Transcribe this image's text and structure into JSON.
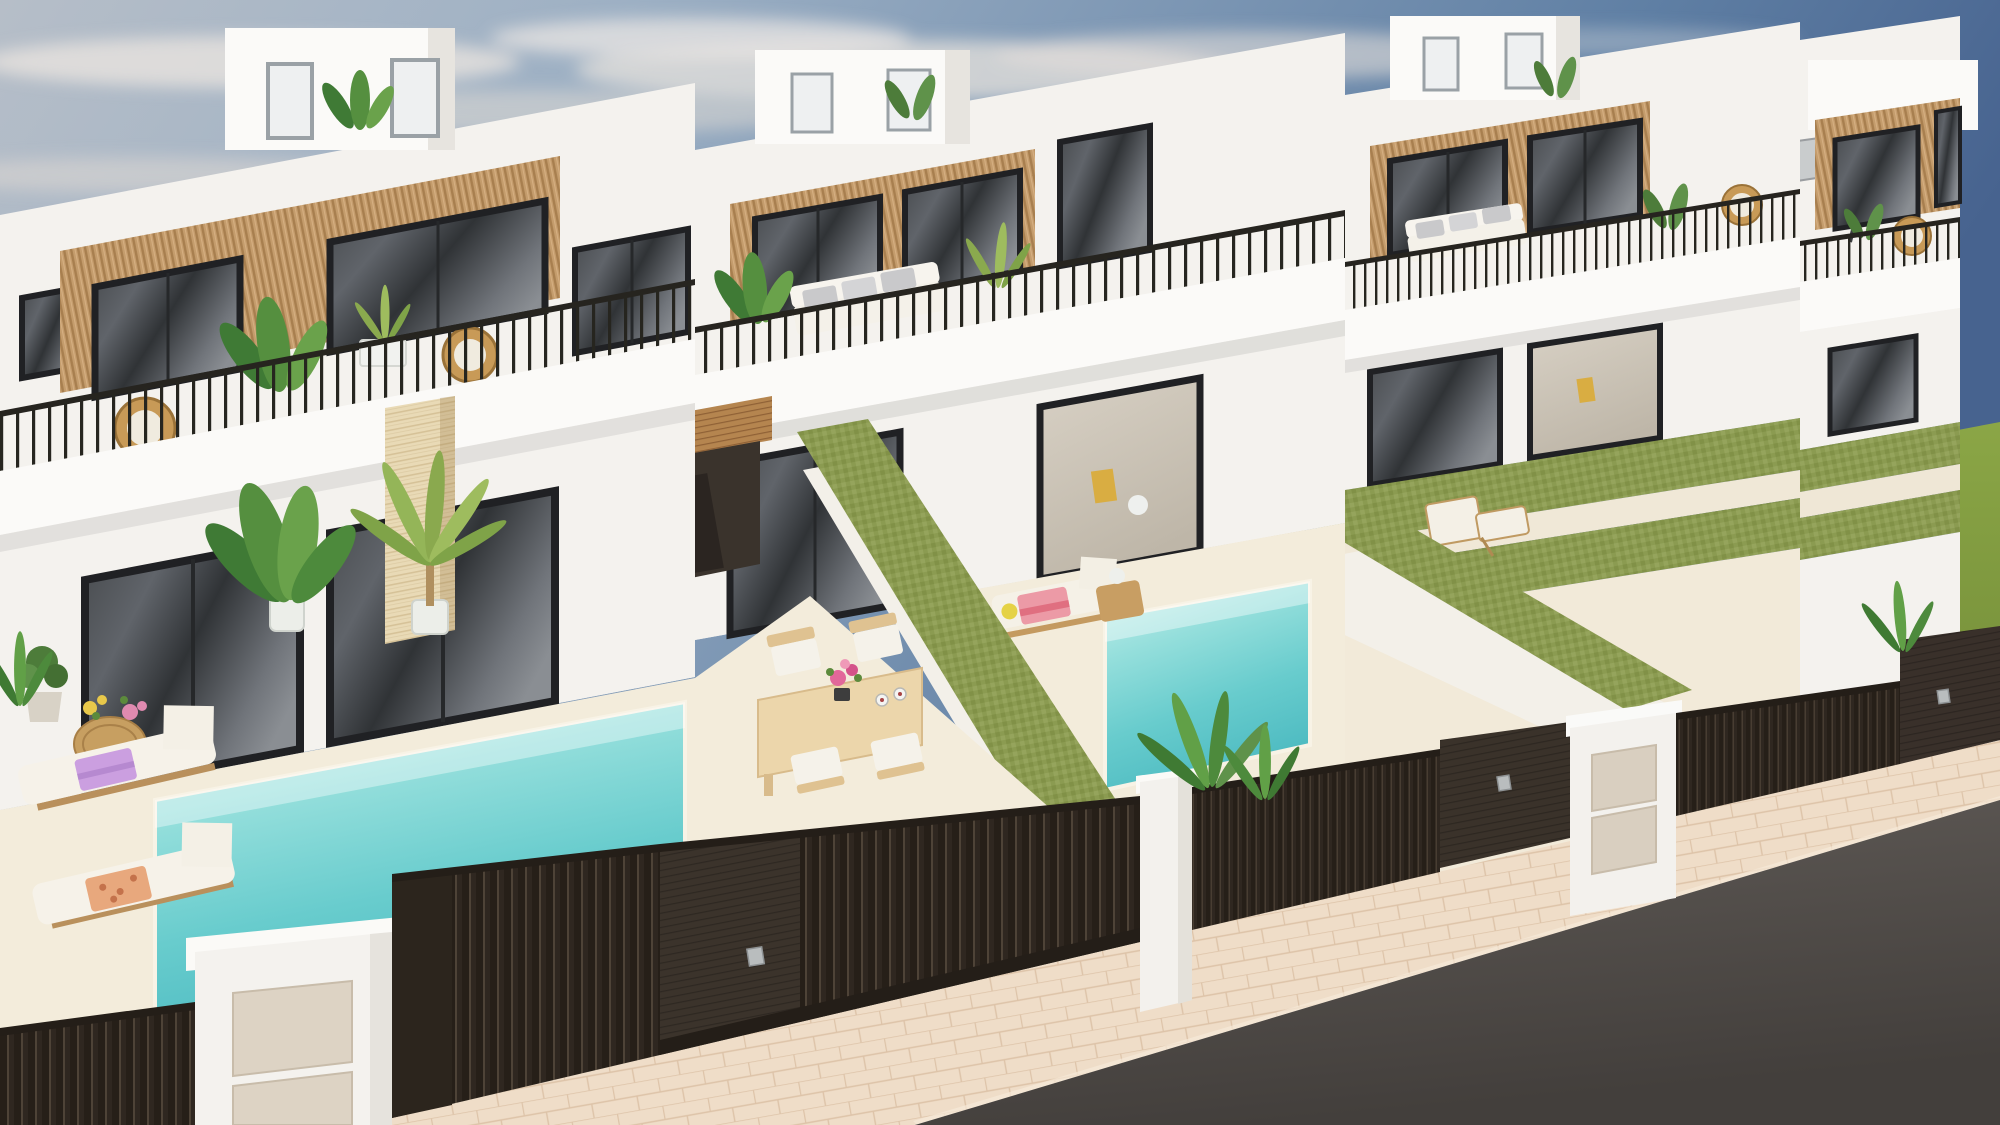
{
  "scene": {
    "description": "Daytime 3D architectural rendering, elevated street view of a row of modern white two-storey villas with rooftop terrace boxes, wood-slat facade accents, black-framed glass doors, balconies with thin black railings and rattan chairs, travertine pillar accents, private cream patios each with a small turquoise plunge pool, sun loungers with colourful towels, an outdoor dining set with pink flowers, green privacy hedge walls and artificial-grass terraces between units, dark brown slatted entrance gates and fences with white mailbox pillars along a beige paved sidewalk, and a dark asphalt road in the bottom-right corner under a partly cloudy blue sky with a green grass horizon at the far right."
  },
  "palette": {
    "sky_deep_blue": "#4f6b92",
    "sky_haze": "#b6bec8",
    "cloud_white": "#e8e3de",
    "wall_white": "#f4f2ee",
    "wall_sunlit": "#fbfaf8",
    "wall_shade": "#e7e4df",
    "wood_slat": "#c49c6c",
    "travertine": "#e9dab6",
    "glass_dark": "#3c4043",
    "railing_black": "#26251f",
    "hedge_green": "#8b9b51",
    "lawn_green": "#86a03c",
    "pool_turquoise": "#68cccd",
    "patio_cream": "#f3ecdb",
    "fence_brown": "#2a231c",
    "sidewalk_beige": "#efddc8",
    "road_asphalt": "#54504c",
    "towel_pink": "#ec9aa6",
    "towel_purple": "#cb9fe0",
    "towel_coral": "#e8a87d",
    "flower_pink": "#e2679a",
    "lounger_wood": "#c49a60"
  },
  "objects": {
    "villas_visible": 4,
    "rooftop_terrace_boxes": 4,
    "plunge_pools_visible": 2,
    "sun_loungers": 4,
    "dining_chairs": 4,
    "rattan_chairs": 4,
    "privacy_hedge_walls": 2,
    "grass_terraces": 4,
    "entrance_gates": 4,
    "mailbox_pillars": 3,
    "cantilever_umbrella": 1
  }
}
